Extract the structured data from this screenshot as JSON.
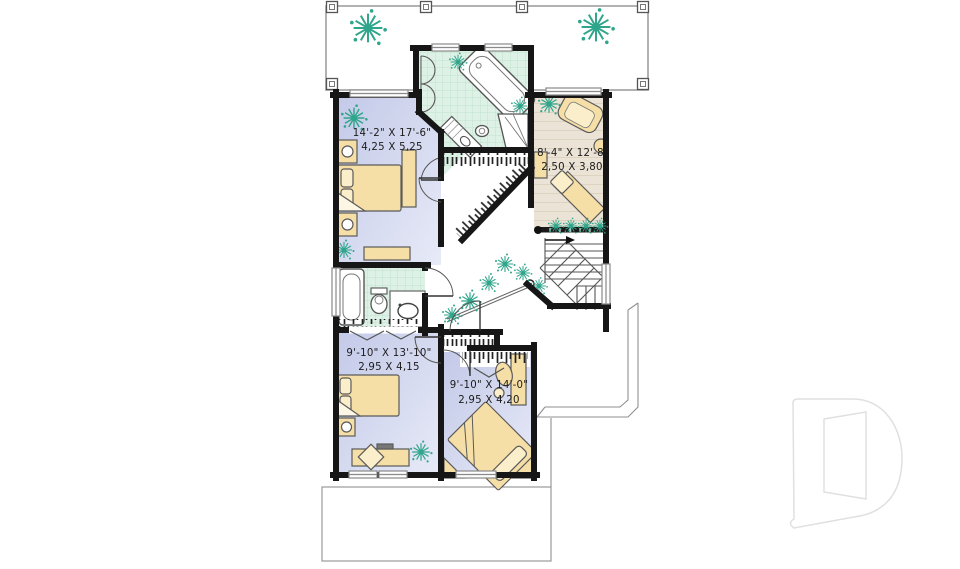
{
  "plan": {
    "type": "second-floor-plan",
    "rooms": {
      "master_bedroom": {
        "imperial": "14'-2\" X 17'-6\"",
        "metric": "4,25 X 5,25"
      },
      "den": {
        "imperial": "8'-4\" X 12'-8\"",
        "metric": "2,50 X 3,80"
      },
      "bedroom2": {
        "imperial": "9'-10\" X 13'-10\"",
        "metric": "2,95 X 4,15"
      },
      "bedroom3": {
        "imperial": "9'-10\" X 14'-0\"",
        "metric": "2,95 X 4,20"
      }
    },
    "features": [
      "deck",
      "ensuite-bathroom",
      "walk-in-closet",
      "second-bathroom",
      "staircase",
      "hall-railing",
      "closets",
      "roof-outline"
    ],
    "colors": {
      "wall": "#161616",
      "bedroom_floor_light": "#e7eaf7",
      "bedroom_floor_dark": "#c3c9e8",
      "bathroom_tile": "#def1e6",
      "bathroom_tile_line": "#c2e2cf",
      "den_floor": "#eae3d6",
      "furniture": "#f6dfa7",
      "furniture_light": "#fbeecb",
      "plant": "#2fa58b",
      "window": "#8a8a8a",
      "roof_outline": "#8f8f8f",
      "logo_watermark": "#e0e0e0"
    },
    "logo": {
      "glyph": "D"
    }
  }
}
